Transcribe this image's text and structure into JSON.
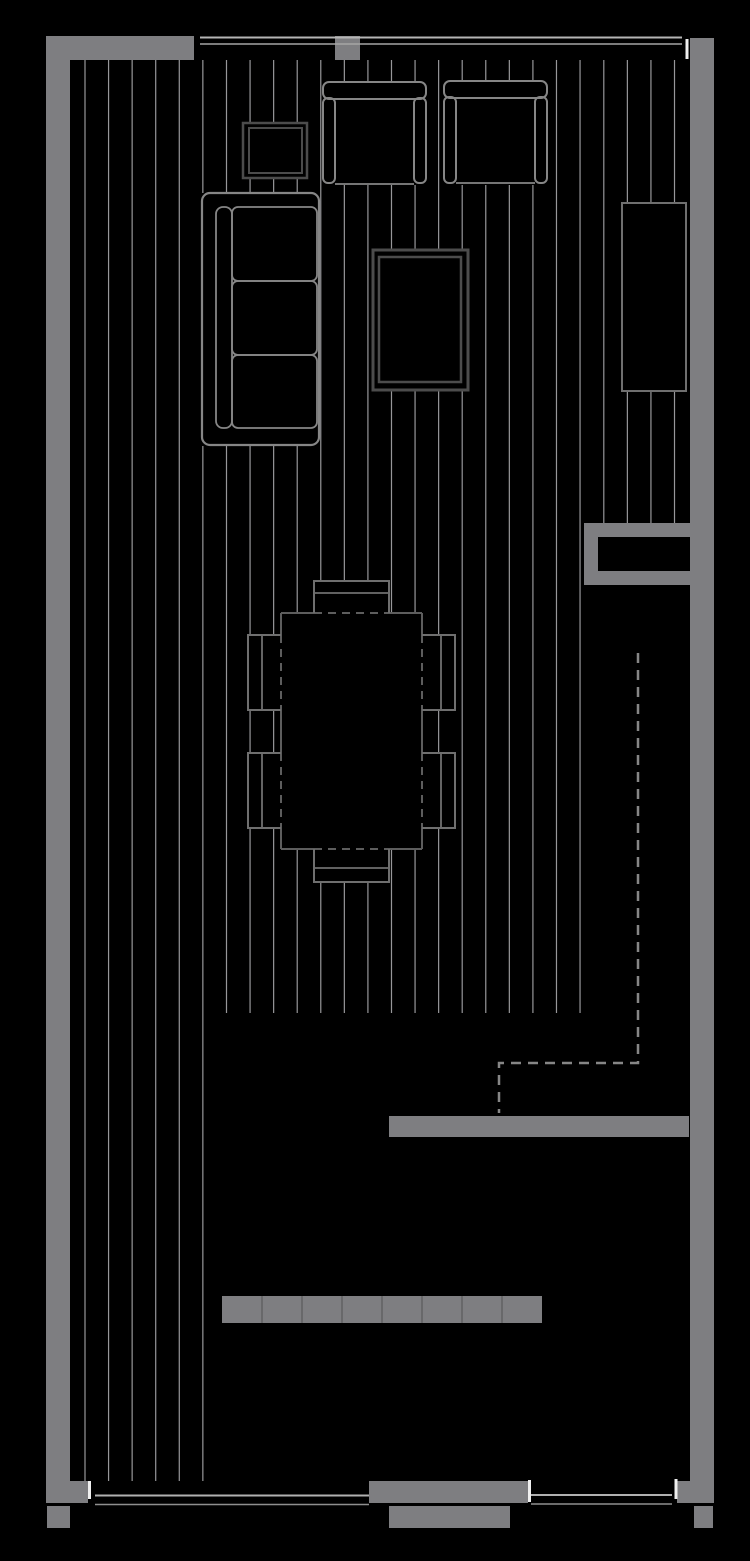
{
  "canvas": {
    "width": 750,
    "height": 1561,
    "background": "#000000"
  },
  "palette": {
    "background": "#000000",
    "wall_fill": "#7e7e81",
    "floor_line": "#97979a",
    "stroke_light": "#868686",
    "stroke_mid": "#6f6f6f",
    "stroke_table": "#5d5d5d",
    "stroke_dark": "#4c4c4c",
    "window_line": "#b5b5b5",
    "window_line_thin": "#8f8f8f",
    "window_cap": "#efefef",
    "dash_guide": "#868686",
    "planter_tick": "#606063"
  },
  "floor_lines": {
    "color": "#97979a",
    "width": 1.2,
    "groups": [
      {
        "name": "deck-left-boards",
        "x_start": 85.0,
        "step": 23.57,
        "count": 6,
        "y1": 60,
        "y2": 1481
      },
      {
        "name": "deck-main-boards",
        "x_start": 226.5,
        "step": 23.57,
        "count": 16,
        "y1": 60,
        "y2": 1013
      },
      {
        "name": "deck-right-boards",
        "x_start": 603.8,
        "step": 23.57,
        "count": 4,
        "y1": 60,
        "y2": 523
      }
    ]
  },
  "shapes": [
    {
      "name": "wall-top-left",
      "type": "rect",
      "x": 46,
      "y": 36,
      "w": 148,
      "h": 24,
      "fill": "#7e7e81"
    },
    {
      "name": "wall-left",
      "type": "rect",
      "x": 46,
      "y": 36,
      "w": 24,
      "h": 1467,
      "fill": "#7e7e81"
    },
    {
      "name": "wall-left-stub",
      "type": "rect",
      "x": 70,
      "y": 1481,
      "w": 18,
      "h": 22,
      "fill": "#7e7e81"
    },
    {
      "name": "wall-left-footing",
      "type": "rect",
      "x": 47,
      "y": 1506,
      "w": 23,
      "h": 22,
      "fill": "#7e7e81"
    },
    {
      "name": "window-post-top",
      "type": "rect",
      "x": 335,
      "y": 36,
      "w": 25,
      "h": 24,
      "fill": "#7e7e81"
    },
    {
      "name": "wall-right",
      "type": "rect",
      "x": 690,
      "y": 38,
      "w": 24,
      "h": 1465,
      "fill": "#7e7e81"
    },
    {
      "name": "wall-right-step",
      "type": "rect",
      "x": 677,
      "y": 1481,
      "w": 13,
      "h": 22,
      "fill": "#7e7e81"
    },
    {
      "name": "wall-right-footing",
      "type": "rect",
      "x": 694,
      "y": 1506,
      "w": 19,
      "h": 22,
      "fill": "#7e7e81"
    },
    {
      "name": "wall-middle-bottom",
      "type": "rect",
      "x": 389,
      "y": 1116,
      "w": 300,
      "h": 21,
      "fill": "#7e7e81"
    },
    {
      "name": "entry-niche-outer",
      "type": "rect",
      "x": 584,
      "y": 523,
      "w": 106,
      "h": 62,
      "fill": "#7e7e81"
    },
    {
      "name": "entry-niche-inner",
      "type": "rect",
      "x": 598,
      "y": 537,
      "w": 92,
      "h": 34,
      "fill": "#000000"
    },
    {
      "name": "wall-bottom-center",
      "type": "rect",
      "x": 369,
      "y": 1481,
      "w": 159,
      "h": 22,
      "fill": "#7e7e81"
    },
    {
      "name": "step-bottom",
      "type": "rect",
      "x": 389,
      "y": 1506,
      "w": 121,
      "h": 22,
      "fill": "#7e7e81"
    },
    {
      "name": "planter-bench",
      "type": "rect",
      "x": 222,
      "y": 1296,
      "w": 320,
      "h": 27,
      "fill": "#7e7e81"
    },
    {
      "name": "planter-tick",
      "type": "line",
      "x1": 262,
      "y1": 1296,
      "x2": 262,
      "y2": 1323,
      "stroke": "#606063",
      "sw": 1.5
    },
    {
      "name": "planter-tick",
      "type": "line",
      "x1": 302,
      "y1": 1296,
      "x2": 302,
      "y2": 1323,
      "stroke": "#606063",
      "sw": 1.5
    },
    {
      "name": "planter-tick",
      "type": "line",
      "x1": 342,
      "y1": 1296,
      "x2": 342,
      "y2": 1323,
      "stroke": "#606063",
      "sw": 1.5
    },
    {
      "name": "planter-tick",
      "type": "line",
      "x1": 382,
      "y1": 1296,
      "x2": 382,
      "y2": 1323,
      "stroke": "#606063",
      "sw": 1.5
    },
    {
      "name": "planter-tick",
      "type": "line",
      "x1": 422,
      "y1": 1296,
      "x2": 422,
      "y2": 1323,
      "stroke": "#606063",
      "sw": 1.5
    },
    {
      "name": "planter-tick",
      "type": "line",
      "x1": 462,
      "y1": 1296,
      "x2": 462,
      "y2": 1323,
      "stroke": "#606063",
      "sw": 1.5
    },
    {
      "name": "planter-tick",
      "type": "line",
      "x1": 502,
      "y1": 1296,
      "x2": 502,
      "y2": 1323,
      "stroke": "#606063",
      "sw": 1.5
    },
    {
      "name": "window-top-outer-line",
      "type": "line",
      "x1": 200,
      "y1": 37.5,
      "x2": 682,
      "y2": 37.5,
      "stroke": "#b5b5b5",
      "sw": 2
    },
    {
      "name": "window-top-inner-line",
      "type": "line",
      "x1": 200,
      "y1": 44,
      "x2": 682,
      "y2": 44,
      "stroke": "#a5a5a5",
      "sw": 1.5
    },
    {
      "name": "window-top-end-cap",
      "type": "line",
      "x1": 687,
      "y1": 39,
      "x2": 687,
      "y2": 59,
      "stroke": "#efefef",
      "sw": 3
    },
    {
      "name": "window-bottom-left-outer-line",
      "type": "line",
      "x1": 95,
      "y1": 1495.5,
      "x2": 369,
      "y2": 1495.5,
      "stroke": "#b0b0b0",
      "sw": 2
    },
    {
      "name": "window-bottom-left-inner-line",
      "type": "line",
      "x1": 95,
      "y1": 1504.5,
      "x2": 369,
      "y2": 1504.5,
      "stroke": "#8f8f8f",
      "sw": 1.5
    },
    {
      "name": "window-bottom-left-cap",
      "type": "line",
      "x1": 89.5,
      "y1": 1481,
      "x2": 89.5,
      "y2": 1499,
      "stroke": "#efefef",
      "sw": 3
    },
    {
      "name": "window-bottom-right-outer-line",
      "type": "line",
      "x1": 531,
      "y1": 1495,
      "x2": 672,
      "y2": 1495,
      "stroke": "#b0b0b0",
      "sw": 2
    },
    {
      "name": "window-bottom-right-inner-line",
      "type": "line",
      "x1": 531,
      "y1": 1504,
      "x2": 672,
      "y2": 1504,
      "stroke": "#8f8f8f",
      "sw": 1.5
    },
    {
      "name": "window-bottom-right-cap-left",
      "type": "line",
      "x1": 529.5,
      "y1": 1480,
      "x2": 529.5,
      "y2": 1502,
      "stroke": "#efefef",
      "sw": 3
    },
    {
      "name": "window-bottom-right-cap-right",
      "type": "line",
      "x1": 676,
      "y1": 1479,
      "x2": 676,
      "y2": 1499,
      "stroke": "#efefef",
      "sw": 3
    },
    {
      "name": "upper-floor-dashed-outline",
      "type": "path",
      "d": "M638,653 L638,1063 L499,1063 L499,1113",
      "stroke": "#868686",
      "sw": 2.5,
      "fill": "none",
      "dash": "10 7"
    },
    {
      "name": "side-table",
      "type": "rect",
      "x": 243,
      "y": 123,
      "w": 64,
      "h": 55,
      "fill": "#000000",
      "stroke": "#4c4c4c",
      "sw": 2.5
    },
    {
      "name": "side-table-inner",
      "type": "rect",
      "x": 249,
      "y": 128,
      "w": 53,
      "h": 45,
      "fill": "none",
      "stroke": "#4c4c4c",
      "sw": 2
    },
    {
      "name": "armchair-1-fill",
      "type": "rect",
      "x": 323,
      "y": 82,
      "w": 103,
      "h": 103,
      "fill": "#000000"
    },
    {
      "name": "armchair-1-back",
      "type": "rect",
      "x": 323,
      "y": 82,
      "w": 103,
      "h": 17,
      "rx": 6,
      "fill": "none",
      "stroke": "#868686",
      "sw": 2
    },
    {
      "name": "armchair-1-arm-left",
      "type": "rect",
      "x": 323,
      "y": 98,
      "w": 12,
      "h": 85,
      "rx": 5,
      "fill": "none",
      "stroke": "#868686",
      "sw": 2
    },
    {
      "name": "armchair-1-arm-right",
      "type": "rect",
      "x": 414,
      "y": 98,
      "w": 12,
      "h": 85,
      "rx": 5,
      "fill": "none",
      "stroke": "#868686",
      "sw": 2
    },
    {
      "name": "armchair-1-seat-front",
      "type": "line",
      "x1": 335,
      "y1": 184,
      "x2": 414,
      "y2": 184,
      "stroke": "#868686",
      "sw": 1.8
    },
    {
      "name": "armchair-2-fill",
      "type": "rect",
      "x": 444,
      "y": 81,
      "w": 103,
      "h": 104,
      "fill": "#000000"
    },
    {
      "name": "armchair-2-back",
      "type": "rect",
      "x": 444,
      "y": 81,
      "w": 103,
      "h": 17,
      "rx": 6,
      "fill": "none",
      "stroke": "#868686",
      "sw": 2
    },
    {
      "name": "armchair-2-arm-left",
      "type": "rect",
      "x": 444,
      "y": 97,
      "w": 12,
      "h": 86,
      "rx": 5,
      "fill": "none",
      "stroke": "#868686",
      "sw": 2
    },
    {
      "name": "armchair-2-arm-right",
      "type": "rect",
      "x": 535,
      "y": 97,
      "w": 12,
      "h": 86,
      "rx": 5,
      "fill": "none",
      "stroke": "#868686",
      "sw": 2
    },
    {
      "name": "armchair-2-seat-front",
      "type": "line",
      "x1": 456,
      "y1": 183,
      "x2": 535,
      "y2": 183,
      "stroke": "#868686",
      "sw": 1.8
    },
    {
      "name": "sofa-fill",
      "type": "rect",
      "x": 202,
      "y": 193,
      "w": 117,
      "h": 253,
      "fill": "#000000"
    },
    {
      "name": "sofa-outline",
      "type": "rect",
      "x": 202,
      "y": 193,
      "w": 117,
      "h": 252,
      "rx": 8,
      "fill": "none",
      "stroke": "#868686",
      "sw": 2.2
    },
    {
      "name": "sofa-back-rail",
      "type": "rect",
      "x": 216,
      "y": 207,
      "w": 16,
      "h": 221,
      "rx": 7,
      "fill": "none",
      "stroke": "#868686",
      "sw": 1.8
    },
    {
      "name": "sofa-cushion-1",
      "type": "rect",
      "x": 232,
      "y": 207,
      "w": 85,
      "h": 74,
      "rx": 6,
      "fill": "none",
      "stroke": "#868686",
      "sw": 1.8
    },
    {
      "name": "sofa-cushion-2",
      "type": "rect",
      "x": 232,
      "y": 281,
      "w": 85,
      "h": 74,
      "rx": 6,
      "fill": "none",
      "stroke": "#868686",
      "sw": 1.8
    },
    {
      "name": "sofa-cushion-3",
      "type": "rect",
      "x": 232,
      "y": 355,
      "w": 85,
      "h": 73,
      "rx": 6,
      "fill": "none",
      "stroke": "#868686",
      "sw": 1.8
    },
    {
      "name": "tv-table",
      "type": "rect",
      "x": 373,
      "y": 250,
      "w": 95,
      "h": 140,
      "fill": "#000000",
      "stroke": "#4c4c4c",
      "sw": 3
    },
    {
      "name": "tv-table-inner",
      "type": "rect",
      "x": 379,
      "y": 257,
      "w": 82,
      "h": 125,
      "fill": "none",
      "stroke": "#4c4c4c",
      "sw": 2.5
    },
    {
      "name": "cabinet-right",
      "type": "rect",
      "x": 622,
      "y": 203,
      "w": 64,
      "h": 188,
      "fill": "#000000",
      "stroke": "#6f6f6f",
      "sw": 2
    },
    {
      "name": "dining-bench-top-fill",
      "type": "rect",
      "x": 314,
      "y": 581,
      "w": 75,
      "h": 32,
      "fill": "#000000"
    },
    {
      "name": "dining-bench-bottom-fill",
      "type": "rect",
      "x": 314,
      "y": 849,
      "w": 75,
      "h": 33,
      "fill": "#000000"
    },
    {
      "name": "dining-chair-left-upper-fill",
      "type": "rect",
      "x": 248,
      "y": 635,
      "w": 33,
      "h": 75,
      "fill": "#000000"
    },
    {
      "name": "dining-chair-left-lower-fill",
      "type": "rect",
      "x": 248,
      "y": 753,
      "w": 33,
      "h": 75,
      "fill": "#000000"
    },
    {
      "name": "dining-chair-right-upper-fill",
      "type": "rect",
      "x": 422,
      "y": 635,
      "w": 33,
      "h": 75,
      "fill": "#000000"
    },
    {
      "name": "dining-chair-right-lower-fill",
      "type": "rect",
      "x": 422,
      "y": 753,
      "w": 33,
      "h": 75,
      "fill": "#000000"
    },
    {
      "name": "dining-table-fill",
      "type": "rect",
      "x": 281,
      "y": 613,
      "w": 141,
      "h": 236,
      "fill": "#000000"
    },
    {
      "name": "dining-table-edge",
      "type": "line",
      "x1": 281,
      "y1": 613,
      "x2": 314,
      "y2": 613,
      "stroke": "#5d5d5d",
      "sw": 2
    },
    {
      "name": "dining-table-edge",
      "type": "line",
      "x1": 389,
      "y1": 613,
      "x2": 422,
      "y2": 613,
      "stroke": "#5d5d5d",
      "sw": 2
    },
    {
      "name": "dining-table-edge",
      "type": "line",
      "x1": 281,
      "y1": 849,
      "x2": 314,
      "y2": 849,
      "stroke": "#5d5d5d",
      "sw": 2
    },
    {
      "name": "dining-table-edge",
      "type": "line",
      "x1": 389,
      "y1": 849,
      "x2": 422,
      "y2": 849,
      "stroke": "#5d5d5d",
      "sw": 2
    },
    {
      "name": "dining-table-edge",
      "type": "line",
      "x1": 281,
      "y1": 613,
      "x2": 281,
      "y2": 635,
      "stroke": "#5d5d5d",
      "sw": 2
    },
    {
      "name": "dining-table-edge",
      "type": "line",
      "x1": 281,
      "y1": 710,
      "x2": 281,
      "y2": 753,
      "stroke": "#5d5d5d",
      "sw": 2
    },
    {
      "name": "dining-table-edge",
      "type": "line",
      "x1": 281,
      "y1": 828,
      "x2": 281,
      "y2": 849,
      "stroke": "#5d5d5d",
      "sw": 2
    },
    {
      "name": "dining-table-edge",
      "type": "line",
      "x1": 422,
      "y1": 613,
      "x2": 422,
      "y2": 635,
      "stroke": "#5d5d5d",
      "sw": 2
    },
    {
      "name": "dining-table-edge",
      "type": "line",
      "x1": 422,
      "y1": 710,
      "x2": 422,
      "y2": 753,
      "stroke": "#5d5d5d",
      "sw": 2
    },
    {
      "name": "dining-table-edge",
      "type": "line",
      "x1": 422,
      "y1": 828,
      "x2": 422,
      "y2": 849,
      "stroke": "#5d5d5d",
      "sw": 2
    },
    {
      "name": "dining-table-edge-hidden",
      "type": "line",
      "x1": 314,
      "y1": 613,
      "x2": 389,
      "y2": 613,
      "stroke": "#5d5d5d",
      "sw": 2,
      "dash": "8 6"
    },
    {
      "name": "dining-table-edge-hidden",
      "type": "line",
      "x1": 314,
      "y1": 849,
      "x2": 389,
      "y2": 849,
      "stroke": "#5d5d5d",
      "sw": 2,
      "dash": "8 6"
    },
    {
      "name": "dining-table-edge-hidden",
      "type": "line",
      "x1": 281,
      "y1": 635,
      "x2": 281,
      "y2": 710,
      "stroke": "#5d5d5d",
      "sw": 2,
      "dash": "8 6"
    },
    {
      "name": "dining-table-edge-hidden",
      "type": "line",
      "x1": 281,
      "y1": 753,
      "x2": 281,
      "y2": 828,
      "stroke": "#5d5d5d",
      "sw": 2,
      "dash": "8 6"
    },
    {
      "name": "dining-table-edge-hidden",
      "type": "line",
      "x1": 422,
      "y1": 635,
      "x2": 422,
      "y2": 710,
      "stroke": "#5d5d5d",
      "sw": 2,
      "dash": "8 6"
    },
    {
      "name": "dining-table-edge-hidden",
      "type": "line",
      "x1": 422,
      "y1": 753,
      "x2": 422,
      "y2": 828,
      "stroke": "#5d5d5d",
      "sw": 2,
      "dash": "8 6"
    },
    {
      "name": "dining-bench-top",
      "type": "path",
      "d": "M314,613 L314,581 L389,581 L389,613",
      "stroke": "#6f6f6f",
      "sw": 2,
      "fill": "none"
    },
    {
      "name": "dining-bench-top-divider",
      "type": "line",
      "x1": 314,
      "y1": 593,
      "x2": 389,
      "y2": 593,
      "stroke": "#6f6f6f",
      "sw": 1.8
    },
    {
      "name": "dining-bench-bottom",
      "type": "path",
      "d": "M314,849 L314,882 L389,882 L389,849",
      "stroke": "#6f6f6f",
      "sw": 2,
      "fill": "none"
    },
    {
      "name": "dining-bench-bottom-divider",
      "type": "line",
      "x1": 314,
      "y1": 868,
      "x2": 389,
      "y2": 868,
      "stroke": "#6f6f6f",
      "sw": 1.8
    },
    {
      "name": "dining-chair-left-upper",
      "type": "path",
      "d": "M281,635 L248,635 L248,710 L281,710",
      "stroke": "#6f6f6f",
      "sw": 2,
      "fill": "none"
    },
    {
      "name": "dining-chair-left-upper-divider",
      "type": "line",
      "x1": 262,
      "y1": 635,
      "x2": 262,
      "y2": 710,
      "stroke": "#6f6f6f",
      "sw": 1.8
    },
    {
      "name": "dining-chair-left-lower",
      "type": "path",
      "d": "M281,753 L248,753 L248,828 L281,828",
      "stroke": "#6f6f6f",
      "sw": 2,
      "fill": "none"
    },
    {
      "name": "dining-chair-left-lower-divider",
      "type": "line",
      "x1": 262,
      "y1": 753,
      "x2": 262,
      "y2": 828,
      "stroke": "#6f6f6f",
      "sw": 1.8
    },
    {
      "name": "dining-chair-right-upper",
      "type": "path",
      "d": "M422,635 L455,635 L455,710 L422,710",
      "stroke": "#6f6f6f",
      "sw": 2,
      "fill": "none"
    },
    {
      "name": "dining-chair-right-upper-divider",
      "type": "line",
      "x1": 441,
      "y1": 635,
      "x2": 441,
      "y2": 710,
      "stroke": "#6f6f6f",
      "sw": 1.8
    },
    {
      "name": "dining-chair-right-lower",
      "type": "path",
      "d": "M422,753 L455,753 L455,828 L422,828",
      "stroke": "#6f6f6f",
      "sw": 2,
      "fill": "none"
    },
    {
      "name": "dining-chair-right-lower-divider",
      "type": "line",
      "x1": 441,
      "y1": 753,
      "x2": 441,
      "y2": 828,
      "stroke": "#6f6f6f",
      "sw": 1.8
    }
  ]
}
